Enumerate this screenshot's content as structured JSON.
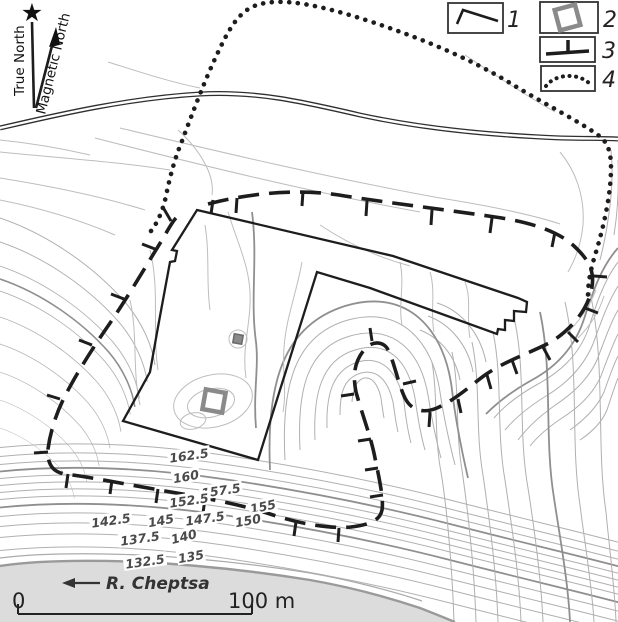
{
  "map": {
    "north": {
      "true_label": "True North",
      "magnetic_label": "Magnetic North"
    },
    "river_label": "R. Cheptsa",
    "scale": {
      "start_label": "0",
      "end_label": "100 m"
    },
    "legend": {
      "items": [
        {
          "num": "1",
          "symbol": "excavation-boundary-line"
        },
        {
          "num": "2",
          "symbol": "pit-square"
        },
        {
          "num": "3",
          "symbol": "scarp-hachure-line"
        },
        {
          "num": "4",
          "symbol": "dotted-site-boundary"
        }
      ]
    },
    "contour_labels": [
      {
        "value": "162.5",
        "x": 189,
        "y": 456,
        "rot": -8
      },
      {
        "value": "160",
        "x": 186,
        "y": 477,
        "rot": -10
      },
      {
        "value": "157.5",
        "x": 221,
        "y": 491,
        "rot": -8
      },
      {
        "value": "152.5",
        "x": 189,
        "y": 501,
        "rot": -8
      },
      {
        "value": "155",
        "x": 263,
        "y": 507,
        "rot": -12
      },
      {
        "value": "147.5",
        "x": 205,
        "y": 519,
        "rot": -8
      },
      {
        "value": "150",
        "x": 248,
        "y": 521,
        "rot": -10
      },
      {
        "value": "142.5",
        "x": 111,
        "y": 521,
        "rot": -8
      },
      {
        "value": "145",
        "x": 161,
        "y": 521,
        "rot": -10
      },
      {
        "value": "140",
        "x": 184,
        "y": 537,
        "rot": -14
      },
      {
        "value": "137.5",
        "x": 140,
        "y": 539,
        "rot": -8
      },
      {
        "value": "135",
        "x": 191,
        "y": 557,
        "rot": -10
      },
      {
        "value": "132.5",
        "x": 145,
        "y": 562,
        "rot": -8
      }
    ],
    "colors": {
      "ink": "#1d1d1d",
      "contour": "#b0b0b0",
      "index_contour": "#8f8f8f",
      "river_fill": "#dcdcdc",
      "gray_square": "#8a8a8a"
    }
  }
}
